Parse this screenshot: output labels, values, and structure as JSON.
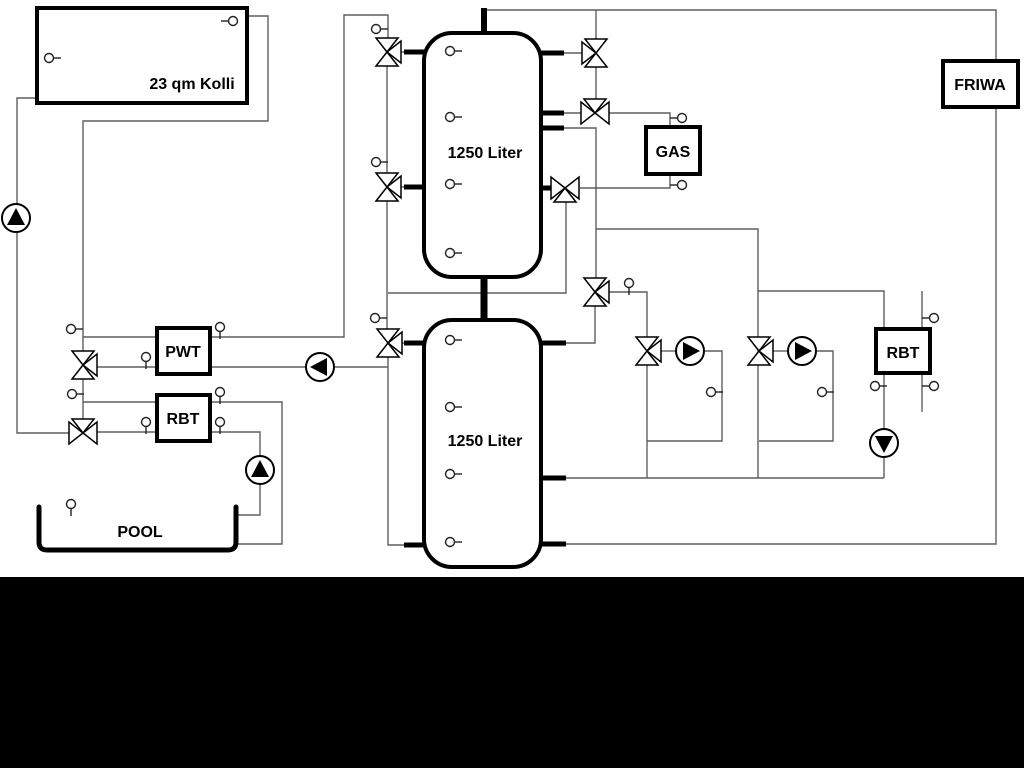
{
  "diagram": {
    "colors": {
      "background": "#ffffff",
      "pipe": "#5f5f5f",
      "component": "#000000",
      "sensor": "#222222",
      "bottom_bar": "#000000"
    },
    "bottom_bar": {
      "x": 0,
      "y": 577,
      "w": 1024,
      "h": 191
    },
    "tanks": [
      {
        "name": "buffer-tank-1",
        "label": "1250 Liter",
        "x": 424,
        "y": 33,
        "w": 117,
        "h": 244,
        "lx": 485,
        "ly": 158
      },
      {
        "name": "buffer-tank-2",
        "label": "1250 Liter",
        "x": 424,
        "y": 320,
        "w": 117,
        "h": 247,
        "lx": 485,
        "ly": 446
      }
    ],
    "boxes": [
      {
        "name": "solar-collector",
        "label": "23 qm Kolli",
        "x": 37,
        "y": 8,
        "w": 210,
        "h": 95,
        "lx": 192,
        "ly": 89
      },
      {
        "name": "gas-boiler",
        "label": "GAS",
        "x": 646,
        "y": 127,
        "w": 54,
        "h": 47,
        "lx": 673,
        "ly": 157
      },
      {
        "name": "friwa-station",
        "label": "FRIWA",
        "x": 943,
        "y": 61,
        "w": 75,
        "h": 46,
        "lx": 980,
        "ly": 90
      },
      {
        "name": "pwt-exchanger",
        "label": "PWT",
        "x": 157,
        "y": 328,
        "w": 53,
        "h": 46,
        "lx": 183,
        "ly": 357
      },
      {
        "name": "rbt-left",
        "label": "RBT",
        "x": 157,
        "y": 395,
        "w": 53,
        "h": 46,
        "lx": 183,
        "ly": 424
      },
      {
        "name": "rbt-right",
        "label": "RBT",
        "x": 876,
        "y": 329,
        "w": 54,
        "h": 44,
        "lx": 903,
        "ly": 358
      }
    ],
    "pool": {
      "name": "pool",
      "label": "POOL",
      "x": 39,
      "y": 507,
      "w": 197,
      "h": 43,
      "lx": 140,
      "ly": 537
    },
    "pipes": [
      {
        "name": "pipe-solar-supply",
        "pts": [
          [
            37,
            98
          ],
          [
            17,
            98
          ],
          [
            17,
            433
          ],
          [
            69,
            433
          ]
        ]
      },
      {
        "name": "pipe-solar-return",
        "pts": [
          [
            247,
            16
          ],
          [
            268,
            16
          ],
          [
            268,
            121
          ],
          [
            83,
            121
          ],
          [
            83,
            352
          ]
        ]
      },
      {
        "name": "pipe-valve83-link",
        "pts": [
          [
            83,
            378
          ],
          [
            83,
            420
          ]
        ]
      },
      {
        "name": "pipe-pwt-primary",
        "pts": [
          [
            83,
            337
          ],
          [
            344,
            337
          ],
          [
            344,
            15
          ],
          [
            388,
            15
          ],
          [
            388,
            39
          ]
        ]
      },
      {
        "name": "pipe-pwt-secondary-left",
        "pts": [
          [
            96,
            367
          ],
          [
            307,
            367
          ]
        ]
      },
      {
        "name": "pipe-pwt-secondary-right",
        "pts": [
          [
            334,
            367
          ],
          [
            388,
            367
          ]
        ]
      },
      {
        "name": "pipe-rbt-supply",
        "pts": [
          [
            83,
            402
          ],
          [
            282,
            402
          ],
          [
            282,
            544
          ],
          [
            237,
            544
          ]
        ]
      },
      {
        "name": "pipe-rbt-return",
        "pts": [
          [
            96,
            432
          ],
          [
            260,
            432
          ],
          [
            260,
            457
          ]
        ]
      },
      {
        "name": "pipe-pool-inlet",
        "pts": [
          [
            260,
            484
          ],
          [
            260,
            515
          ],
          [
            237,
            515
          ]
        ]
      },
      {
        "name": "pipe-left-riser-a",
        "pts": [
          [
            387,
            65
          ],
          [
            387,
            174
          ]
        ]
      },
      {
        "name": "pipe-left-riser-b",
        "pts": [
          [
            387,
            200
          ],
          [
            387,
            330
          ]
        ]
      },
      {
        "name": "pipe-left-riser-c",
        "pts": [
          [
            388,
            356
          ],
          [
            388,
            545
          ],
          [
            412,
            545
          ]
        ]
      },
      {
        "name": "pipe-cross-tie",
        "pts": [
          [
            388,
            293
          ],
          [
            566,
            293
          ],
          [
            566,
            201
          ]
        ]
      },
      {
        "name": "pipe-valve1-port",
        "pts": [
          [
            400,
            52
          ],
          [
            412,
            52
          ]
        ]
      },
      {
        "name": "pipe-valve2-port",
        "pts": [
          [
            400,
            187
          ],
          [
            412,
            187
          ]
        ]
      },
      {
        "name": "pipe-valve3-port",
        "pts": [
          [
            401,
            343
          ],
          [
            412,
            343
          ]
        ]
      },
      {
        "name": "pipe-top-header",
        "pts": [
          [
            484,
            10
          ],
          [
            996,
            10
          ],
          [
            996,
            62
          ]
        ]
      },
      {
        "name": "pipe-friwa-return",
        "pts": [
          [
            996,
            106
          ],
          [
            996,
            544
          ],
          [
            566,
            544
          ]
        ]
      },
      {
        "name": "pipe-v4-up",
        "pts": [
          [
            596,
            10
          ],
          [
            596,
            40
          ]
        ]
      },
      {
        "name": "pipe-v4-v5",
        "pts": [
          [
            596,
            66
          ],
          [
            596,
            100
          ]
        ]
      },
      {
        "name": "pipe-v4-port",
        "pts": [
          [
            582,
            53
          ],
          [
            550,
            53
          ]
        ]
      },
      {
        "name": "pipe-v5-port",
        "pts": [
          [
            581,
            113
          ],
          [
            550,
            113
          ]
        ]
      },
      {
        "name": "pipe-gas-supply",
        "pts": [
          [
            609,
            113
          ],
          [
            670,
            113
          ],
          [
            670,
            128
          ]
        ]
      },
      {
        "name": "pipe-tank1-port128",
        "pts": [
          [
            550,
            128
          ],
          [
            596,
            128
          ],
          [
            596,
            279
          ]
        ]
      },
      {
        "name": "pipe-gas-return",
        "pts": [
          [
            580,
            188
          ],
          [
            670,
            188
          ],
          [
            670,
            173
          ]
        ]
      },
      {
        "name": "pipe-v7-down",
        "pts": [
          [
            595,
            305
          ],
          [
            595,
            343
          ],
          [
            566,
            343
          ]
        ]
      },
      {
        "name": "pipe-v7-branch",
        "pts": [
          [
            609,
            292
          ],
          [
            647,
            292
          ],
          [
            647,
            338
          ]
        ]
      },
      {
        "name": "pipe-right-header",
        "pts": [
          [
            596,
            229
          ],
          [
            758,
            229
          ],
          [
            758,
            478
          ]
        ]
      },
      {
        "name": "pipe-rbt2-supply",
        "pts": [
          [
            758,
            291
          ],
          [
            884,
            291
          ],
          [
            884,
            330
          ]
        ]
      },
      {
        "name": "pipe-heat1-down",
        "pts": [
          [
            647,
            364
          ],
          [
            647,
            478
          ]
        ]
      },
      {
        "name": "pipe-heat1-inlet",
        "pts": [
          [
            661,
            351
          ],
          [
            677,
            351
          ]
        ]
      },
      {
        "name": "pipe-heat1-loop",
        "pts": [
          [
            703,
            351
          ],
          [
            722,
            351
          ],
          [
            722,
            441
          ],
          [
            647,
            441
          ]
        ]
      },
      {
        "name": "pipe-heat2-inlet",
        "pts": [
          [
            773,
            351
          ],
          [
            789,
            351
          ]
        ]
      },
      {
        "name": "pipe-heat2-loop",
        "pts": [
          [
            815,
            351
          ],
          [
            833,
            351
          ],
          [
            833,
            441
          ],
          [
            759,
            441
          ]
        ]
      },
      {
        "name": "pipe-mid-return",
        "pts": [
          [
            566,
            478
          ],
          [
            884,
            478
          ]
        ]
      },
      {
        "name": "pipe-rbt2-down",
        "pts": [
          [
            884,
            372
          ],
          [
            884,
            430
          ]
        ]
      },
      {
        "name": "pipe-rbt2-pump-out",
        "pts": [
          [
            884,
            456
          ],
          [
            884,
            478
          ]
        ]
      },
      {
        "name": "pipe-rbt2-aux",
        "pts": [
          [
            922,
            291
          ],
          [
            922,
            412
          ]
        ]
      }
    ],
    "stubs": [
      {
        "name": "stub-tank1-top",
        "pts": [
          [
            484,
            8
          ],
          [
            484,
            35
          ]
        ],
        "w": 6
      },
      {
        "name": "stub-tank-bridge",
        "pts": [
          [
            484,
            275
          ],
          [
            484,
            322
          ]
        ],
        "w": 7
      },
      {
        "name": "stub-t1-left-52",
        "pts": [
          [
            404,
            52
          ],
          [
            426,
            52
          ]
        ],
        "w": 5
      },
      {
        "name": "stub-t1-left-187",
        "pts": [
          [
            404,
            187
          ],
          [
            426,
            187
          ]
        ],
        "w": 5
      },
      {
        "name": "stub-t1-right-53",
        "pts": [
          [
            539,
            53
          ],
          [
            564,
            53
          ]
        ],
        "w": 5
      },
      {
        "name": "stub-t1-right-113",
        "pts": [
          [
            539,
            113
          ],
          [
            564,
            113
          ]
        ],
        "w": 5
      },
      {
        "name": "stub-t1-right-128",
        "pts": [
          [
            539,
            128
          ],
          [
            564,
            128
          ]
        ],
        "w": 5
      },
      {
        "name": "stub-t1-right-188",
        "pts": [
          [
            539,
            188
          ],
          [
            553,
            188
          ]
        ],
        "w": 5
      },
      {
        "name": "stub-t2-left-343",
        "pts": [
          [
            404,
            343
          ],
          [
            426,
            343
          ]
        ],
        "w": 5
      },
      {
        "name": "stub-t2-right-343",
        "pts": [
          [
            539,
            343
          ],
          [
            566,
            343
          ]
        ],
        "w": 5
      },
      {
        "name": "stub-t2-right-478",
        "pts": [
          [
            539,
            478
          ],
          [
            566,
            478
          ]
        ],
        "w": 5
      },
      {
        "name": "stub-t2-right-544",
        "pts": [
          [
            539,
            544
          ],
          [
            566,
            544
          ]
        ],
        "w": 5
      },
      {
        "name": "stub-t2-left-545",
        "pts": [
          [
            404,
            545
          ],
          [
            426,
            545
          ]
        ],
        "w": 5
      }
    ],
    "valves": [
      {
        "name": "valve-tank1-upper-left",
        "cx": 387,
        "cy": 52,
        "run": "v",
        "branch": "right"
      },
      {
        "name": "valve-tank1-lower-left",
        "cx": 387,
        "cy": 187,
        "run": "v",
        "branch": "right"
      },
      {
        "name": "valve-tank2-left",
        "cx": 388,
        "cy": 343,
        "run": "v",
        "branch": "right"
      },
      {
        "name": "valve-tank1-top-right",
        "cx": 596,
        "cy": 53,
        "run": "v",
        "branch": "left"
      },
      {
        "name": "valve-gas-supply",
        "cx": 595,
        "cy": 113,
        "run": "h",
        "branch": "top"
      },
      {
        "name": "valve-gas-return",
        "cx": 565,
        "cy": 188,
        "run": "h",
        "branch": "bottom"
      },
      {
        "name": "valve-distribution",
        "cx": 595,
        "cy": 292,
        "run": "v",
        "branch": "right"
      },
      {
        "name": "valve-pwt",
        "cx": 83,
        "cy": 365,
        "run": "v",
        "branch": "right"
      },
      {
        "name": "valve-pool",
        "cx": 83,
        "cy": 433,
        "run": "h",
        "branch": "top"
      },
      {
        "name": "valve-heating-1",
        "cx": 647,
        "cy": 351,
        "run": "v",
        "branch": "right"
      },
      {
        "name": "valve-heating-2",
        "cx": 759,
        "cy": 351,
        "run": "v",
        "branch": "right"
      }
    ],
    "pumps": [
      {
        "name": "pump-solar",
        "cx": 16,
        "cy": 218,
        "dir": "up"
      },
      {
        "name": "pump-pwt",
        "cx": 320,
        "cy": 367,
        "dir": "left"
      },
      {
        "name": "pump-heating-1",
        "cx": 690,
        "cy": 351,
        "dir": "right"
      },
      {
        "name": "pump-heating-2",
        "cx": 802,
        "cy": 351,
        "dir": "right"
      },
      {
        "name": "pump-rbt-right",
        "cx": 884,
        "cy": 443,
        "dir": "down"
      },
      {
        "name": "pump-pool",
        "cx": 260,
        "cy": 470,
        "dir": "up"
      }
    ],
    "sensors": [
      {
        "name": "sensor-collector-top",
        "cx": 233,
        "cy": 21,
        "tick": "left"
      },
      {
        "name": "sensor-collector-left",
        "cx": 49,
        "cy": 58,
        "tick": "right"
      },
      {
        "name": "sensor-tank1-1",
        "cx": 450,
        "cy": 51,
        "tick": "right"
      },
      {
        "name": "sensor-tank1-2",
        "cx": 450,
        "cy": 117,
        "tick": "right"
      },
      {
        "name": "sensor-tank1-3",
        "cx": 450,
        "cy": 184,
        "tick": "right"
      },
      {
        "name": "sensor-tank1-4",
        "cx": 450,
        "cy": 253,
        "tick": "right"
      },
      {
        "name": "sensor-tank2-1",
        "cx": 450,
        "cy": 340,
        "tick": "right"
      },
      {
        "name": "sensor-tank2-2",
        "cx": 450,
        "cy": 407,
        "tick": "right"
      },
      {
        "name": "sensor-tank2-3",
        "cx": 450,
        "cy": 474,
        "tick": "right"
      },
      {
        "name": "sensor-tank2-4",
        "cx": 450,
        "cy": 542,
        "tick": "right"
      },
      {
        "name": "sensor-valve1",
        "cx": 376,
        "cy": 29,
        "tick": "right"
      },
      {
        "name": "sensor-valve2",
        "cx": 376,
        "cy": 162,
        "tick": "right"
      },
      {
        "name": "sensor-valve3",
        "cx": 375,
        "cy": 318,
        "tick": "right"
      },
      {
        "name": "sensor-line83-upper",
        "cx": 71,
        "cy": 329,
        "tick": "right"
      },
      {
        "name": "sensor-line83-lower",
        "cx": 72,
        "cy": 394,
        "tick": "right"
      },
      {
        "name": "sensor-pwt-top",
        "cx": 220,
        "cy": 327,
        "tick": "down"
      },
      {
        "name": "sensor-pwt-bottom",
        "cx": 146,
        "cy": 357,
        "tick": "down"
      },
      {
        "name": "sensor-rbt-top",
        "cx": 220,
        "cy": 392,
        "tick": "down"
      },
      {
        "name": "sensor-rbt-bottom-left",
        "cx": 146,
        "cy": 422,
        "tick": "down"
      },
      {
        "name": "sensor-rbt-bottom-right",
        "cx": 220,
        "cy": 422,
        "tick": "down"
      },
      {
        "name": "sensor-gas-supply",
        "cx": 682,
        "cy": 118,
        "tick": "left"
      },
      {
        "name": "sensor-gas-return",
        "cx": 682,
        "cy": 185,
        "tick": "left"
      },
      {
        "name": "sensor-distribution",
        "cx": 629,
        "cy": 283,
        "tick": "down"
      },
      {
        "name": "sensor-heating-1",
        "cx": 711,
        "cy": 392,
        "tick": "right"
      },
      {
        "name": "sensor-heating-2",
        "cx": 822,
        "cy": 392,
        "tick": "right"
      },
      {
        "name": "sensor-rbt-right",
        "cx": 875,
        "cy": 386,
        "tick": "right"
      },
      {
        "name": "sensor-rbt-aux-top",
        "cx": 934,
        "cy": 318,
        "tick": "left"
      },
      {
        "name": "sensor-rbt-aux-bottom",
        "cx": 934,
        "cy": 386,
        "tick": "left"
      },
      {
        "name": "sensor-pool",
        "cx": 71,
        "cy": 504,
        "tick": "down"
      }
    ]
  }
}
